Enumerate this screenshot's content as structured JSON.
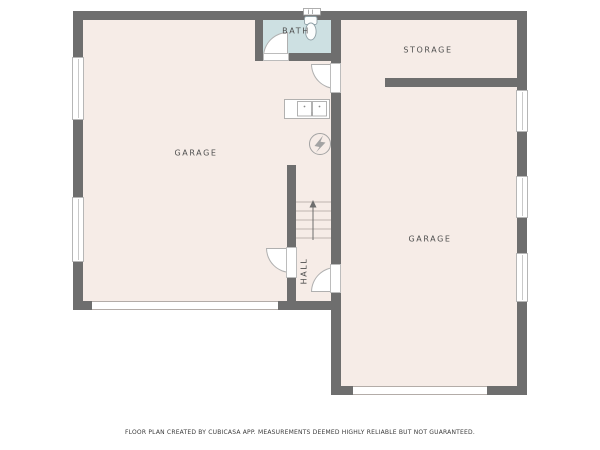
{
  "rooms": {
    "garage_left": {
      "label": "GARAGE"
    },
    "garage_right": {
      "label": "GARAGE"
    },
    "storage": {
      "label": "STORAGE"
    },
    "bath": {
      "label": "BATH"
    },
    "hall": {
      "label": "HALL"
    }
  },
  "fixtures": {
    "toilet": "toilet-icon",
    "double_sink": "double-basin-sink-icon",
    "water_heater": "water-heater-bolt-icon",
    "stairs": "staircase-with-up-arrow",
    "vent": "wall-vent-icon"
  },
  "features": {
    "windows_left_wall": 2,
    "windows_right_wall": 3,
    "garage_doors": 2,
    "interior_door_swings": 4
  },
  "colors": {
    "wall": "#6e6e6e",
    "floor": "#f6ece7",
    "bath_floor": "#cde0e2",
    "background": "#ffffff",
    "label_text": "#4f4f4f"
  },
  "footer": {
    "disclaimer": "FLOOR PLAN CREATED BY CUBICASA APP. MEASUREMENTS DEEMED HIGHLY RELIABLE BUT NOT GUARANTEED."
  }
}
